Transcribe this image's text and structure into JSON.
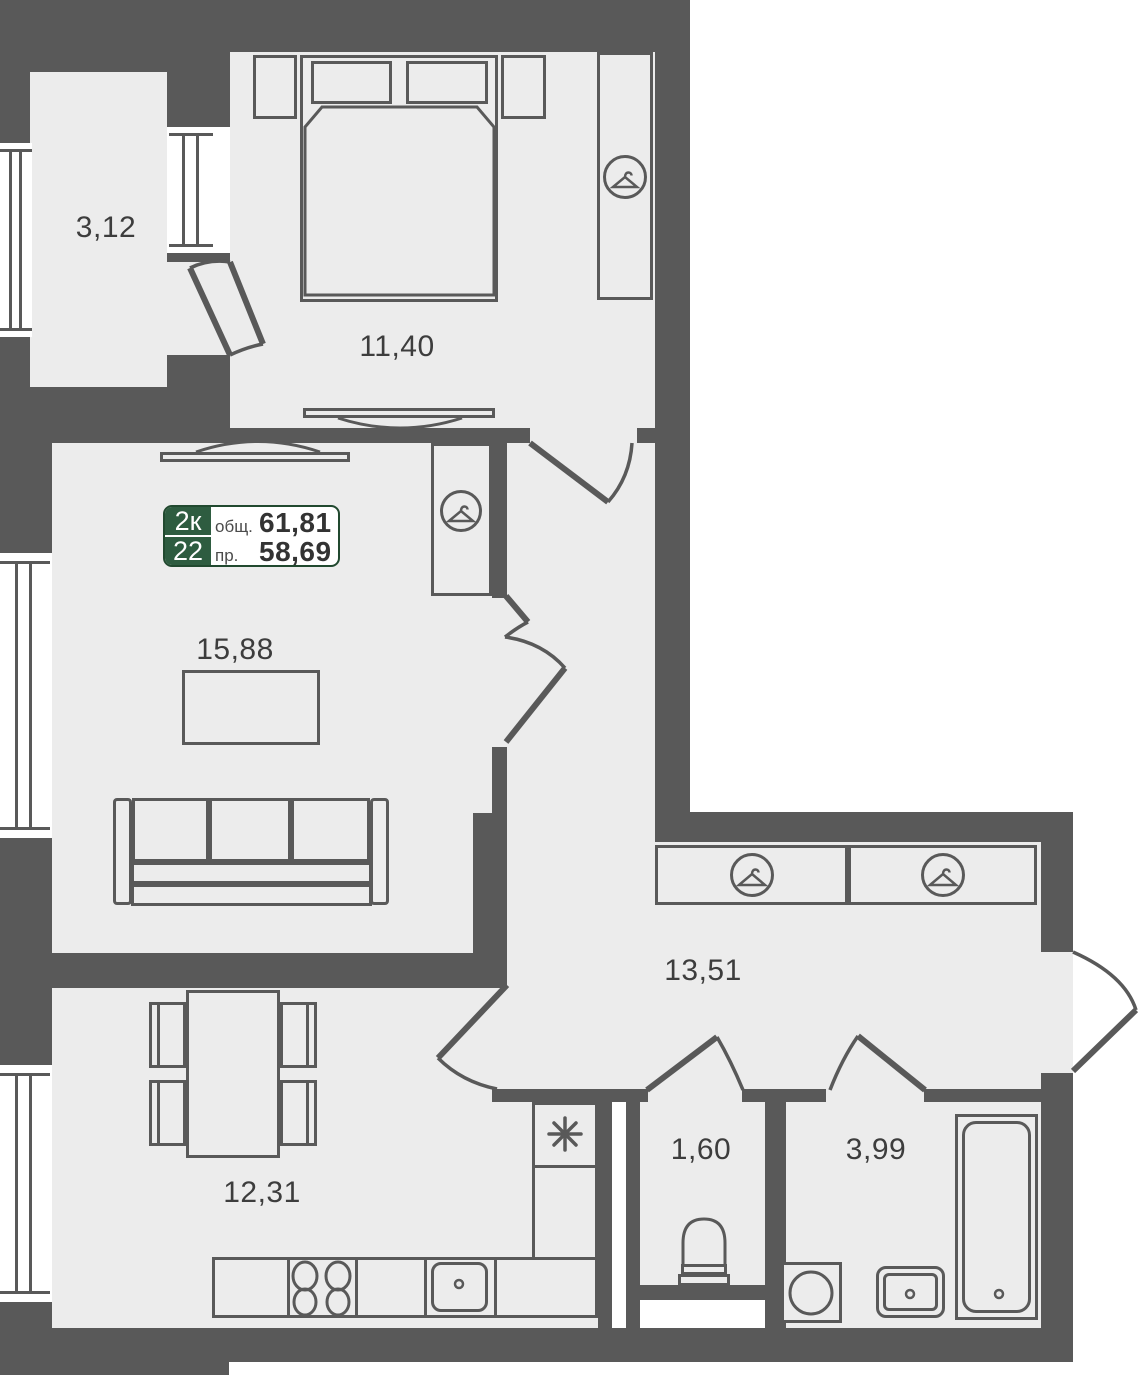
{
  "info_badge": {
    "room_count": "2к",
    "unit_number": "22",
    "total_area_label": "общ.",
    "total_area_value": "61,81",
    "living_area_label": "пр.",
    "living_area_value": "58,69"
  },
  "rooms": {
    "balcony": {
      "label": "3,12"
    },
    "bedroom": {
      "label": "11,40"
    },
    "living_room": {
      "label": "15,88"
    },
    "hallway": {
      "label": "13,51"
    },
    "kitchen": {
      "label": "12,31"
    },
    "wc": {
      "label": "1,60"
    },
    "bathroom": {
      "label": "3,99"
    }
  },
  "icons": {
    "hanger": "hanger-icon (circled clothes hanger, marks wardrobes)",
    "utility_asterisk": "✳"
  },
  "colors": {
    "wall": "#595959",
    "floor": "#ececec",
    "exterior": "#ffffff",
    "badge_green": "#2e5c40",
    "badge_border": "#21492f",
    "text": "#3d3d3d",
    "value": "#333333"
  }
}
